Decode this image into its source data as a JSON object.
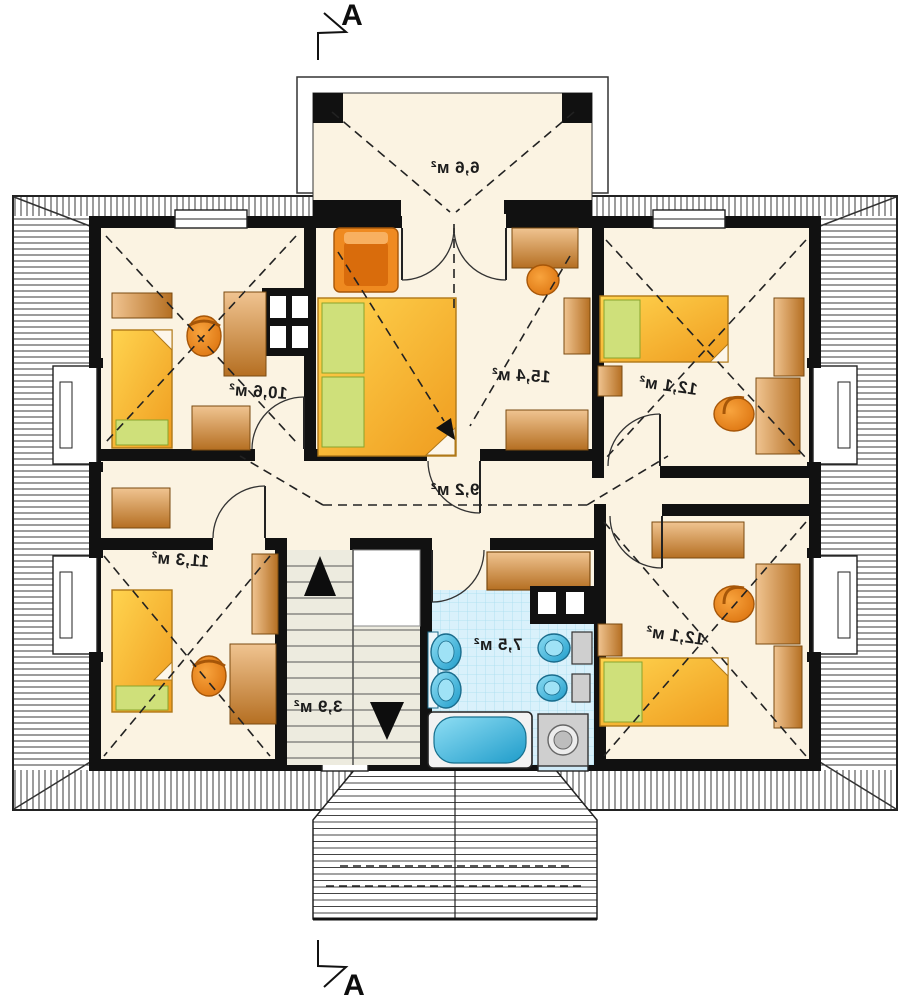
{
  "section_label": "A",
  "rooms": [
    {
      "name": "balcony",
      "area_label": "6,6 м²"
    },
    {
      "name": "bedroom-top-left",
      "area_label": "10,6 м²"
    },
    {
      "name": "bedroom-center",
      "area_label": "15,4 м²"
    },
    {
      "name": "bedroom-top-right",
      "area_label": "12,1 м²"
    },
    {
      "name": "hall",
      "area_label": "9,2 м²"
    },
    {
      "name": "bedroom-bottom-left",
      "area_label": "11,3 м²"
    },
    {
      "name": "staircase",
      "area_label": "3,9 м²"
    },
    {
      "name": "bathroom",
      "area_label": "7,5 м²"
    },
    {
      "name": "bedroom-bottom-right",
      "area_label": "12,1 м²"
    }
  ],
  "notes": {
    "drawing_type": "attic floor plan, mirrored lettering",
    "section_line": "A–A vertical section marker top and bottom"
  },
  "colors": {
    "floor": "#fbf3e2",
    "walls": "#111111",
    "bed_yellow": "#f7b32b",
    "pillow_green": "#cfe07a",
    "furniture_brown": "#c98540",
    "chair_orange": "#ea7f16",
    "bath_tile": "#d9f1fb",
    "fixture_blue": "#3db4e0",
    "stairs_fill": "#edebdf"
  }
}
